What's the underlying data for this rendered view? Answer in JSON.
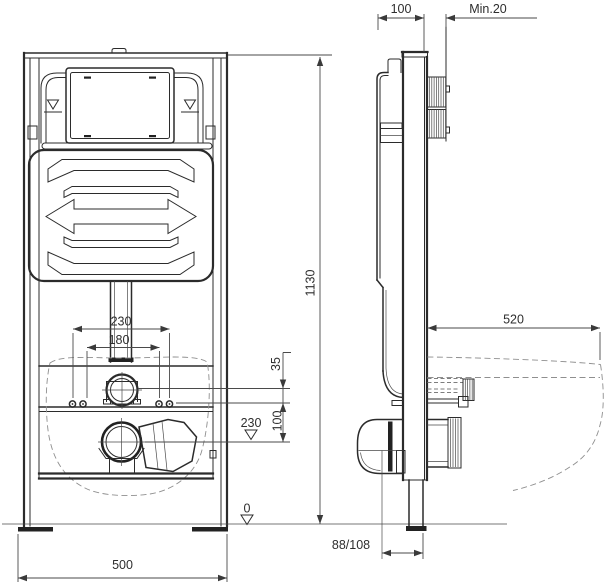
{
  "front_view": {
    "dim_bolt_spacing_outer": "230",
    "dim_bolt_spacing_inner": "180",
    "dim_supply_offset": "35",
    "dim_bolt_to_outlet": "100",
    "datum_outlet_level": "230",
    "datum_floor": "0",
    "dim_frame_width": "500",
    "dim_frame_height": "1130"
  },
  "side_view": {
    "dim_frame_depth": "100",
    "dim_min_wall_clearance": "Min.20",
    "dim_bowl_depth": "520",
    "dim_outlet_to_wall": "88/108"
  },
  "colors": {
    "background": "#ffffff",
    "line": "#2b2b2b",
    "dimension": "#4a4a4a",
    "dashed_outline": "#8f8f8f"
  }
}
